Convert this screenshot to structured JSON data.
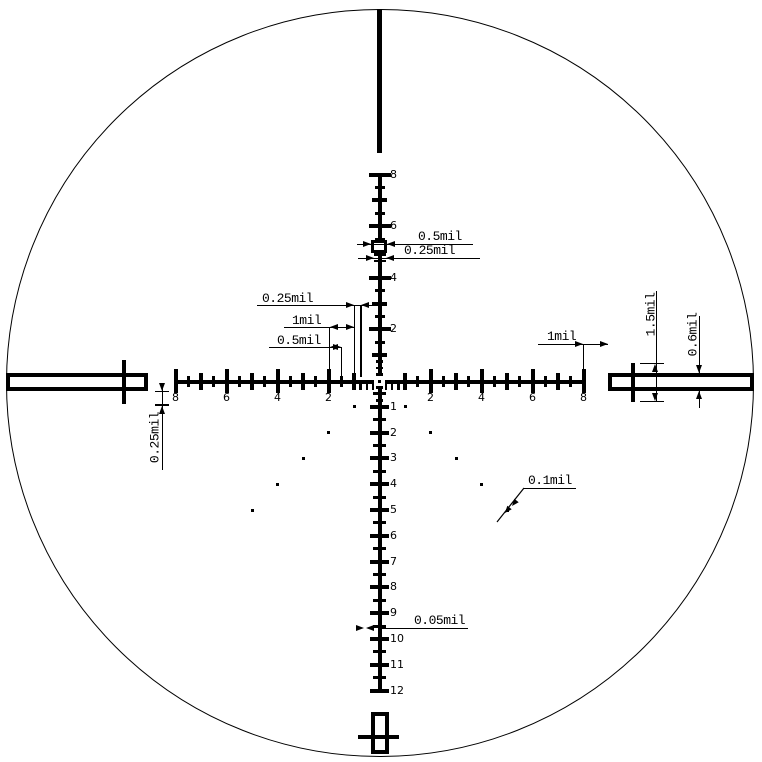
{
  "diagram": {
    "unit_suffix": "mil",
    "geometry": {
      "center_x": 379.5,
      "center_y": 381,
      "mil_px_x": 25.5,
      "mil_px_y": 25.8,
      "circle": {
        "left": 5.5,
        "top": 8.5,
        "diameter": 748
      }
    },
    "axes": {
      "horizontal": {
        "left_tick_labels": [
          "8",
          "6",
          "4",
          "2"
        ],
        "left_tick_mils": [
          8,
          6,
          4,
          2
        ],
        "right_tick_labels": [
          "2",
          "4",
          "6",
          "8"
        ],
        "right_tick_mils": [
          2,
          4,
          6,
          8
        ],
        "range_mils": 8
      },
      "vertical": {
        "upper_tick_labels": [
          "8",
          "6",
          "4",
          "2"
        ],
        "upper_tick_mils": [
          8,
          6,
          4,
          2
        ],
        "lower_tick_labels": [
          "1",
          "2",
          "3",
          "4",
          "5",
          "6",
          "7",
          "8",
          "9",
          "10",
          "11",
          "12"
        ],
        "lower_tick_mils": [
          1,
          2,
          3,
          4,
          5,
          6,
          7,
          8,
          9,
          10,
          11,
          12
        ]
      }
    },
    "holdover_dots": {
      "levels": 5,
      "sides": 2,
      "size_px": 3
    },
    "dimension_labels": {
      "box_width": "0.5mil",
      "top_fine_tick": "0.25mil",
      "left_quarter": "0.25mil",
      "left_one": "1mil",
      "left_half": "0.5mil",
      "axis_start_gap": "0.25mil",
      "right_gap": "1mil",
      "post_tick_height": "1.5mil",
      "post_thickness": "0.6mil",
      "dot_size": "0.1mil",
      "fine_tick_thickness": "0.05mil"
    },
    "colors": {
      "ink": "#000000",
      "background": "#ffffff"
    }
  }
}
